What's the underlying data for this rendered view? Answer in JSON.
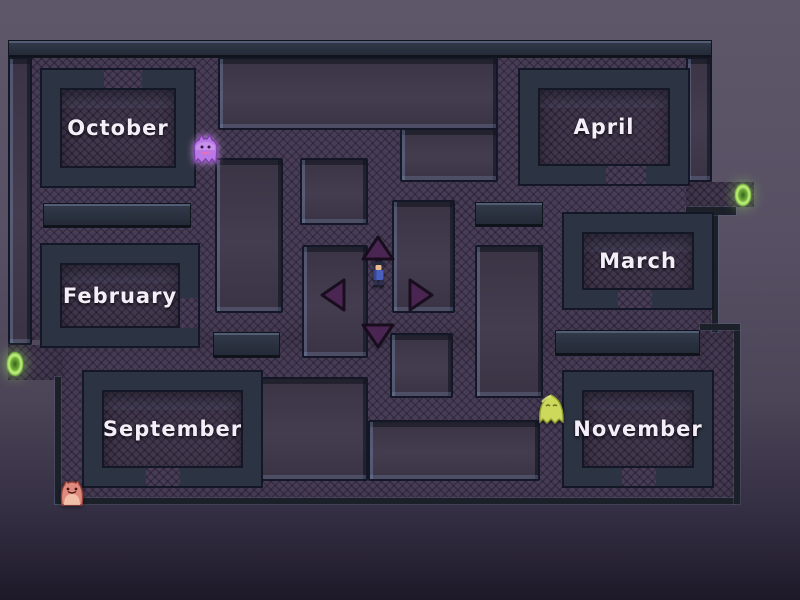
{
  "game": {
    "kind_label": "maze",
    "colors": {
      "path": "#483d56",
      "wall": "#2c3342",
      "slab": "#423b4c",
      "bevel": "#5c6980",
      "outline": "#141826",
      "background_top": "#5e5769",
      "background_bottom": "#1d1928",
      "label_text": "#f4eef8",
      "arrow_fill": "#4c2553",
      "arrow_outline": "#170c1c",
      "portal_green": "#8fd44f"
    },
    "rooms": [
      {
        "id": "october",
        "label": "October"
      },
      {
        "id": "april",
        "label": "April"
      },
      {
        "id": "february",
        "label": "February"
      },
      {
        "id": "march",
        "label": "March"
      },
      {
        "id": "september",
        "label": "September"
      },
      {
        "id": "november",
        "label": "November"
      }
    ],
    "controls": [
      {
        "id": "up",
        "icon": "up-arrow-icon"
      },
      {
        "id": "left",
        "icon": "left-arrow-icon"
      },
      {
        "id": "right",
        "icon": "right-arrow-icon"
      },
      {
        "id": "down",
        "icon": "down-arrow-icon"
      }
    ],
    "characters": [
      {
        "id": "player",
        "role": "player",
        "color": "#4a5fc0"
      },
      {
        "id": "purple-ghost",
        "role": "enemy",
        "color": "#b878e6"
      },
      {
        "id": "yellow-ghost",
        "role": "enemy",
        "color": "#ccd95b"
      },
      {
        "id": "red-monster",
        "role": "enemy",
        "color": "#e08a7d"
      }
    ],
    "portals": [
      {
        "id": "left-portal",
        "color": "#8fd44f"
      },
      {
        "id": "right-portal",
        "color": "#8fd44f"
      }
    ]
  }
}
